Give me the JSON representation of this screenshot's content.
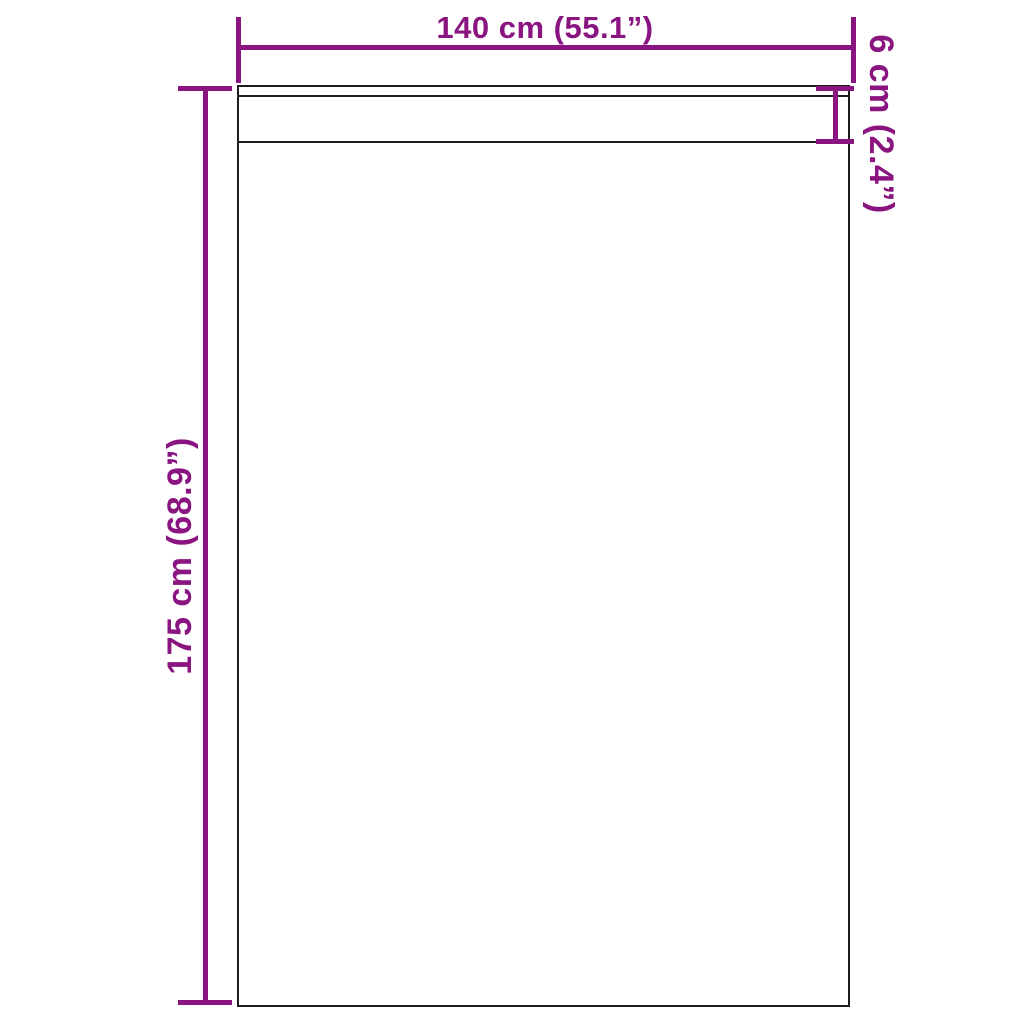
{
  "diagram": {
    "background_color": "#ffffff",
    "outline_color": "#1d1d1b",
    "dimension_color": "#8a1480",
    "labels": {
      "width": "140 cm (55.1”)",
      "height": "175 cm (68.9”)",
      "header_height": "6 cm (2.4”)"
    }
  }
}
